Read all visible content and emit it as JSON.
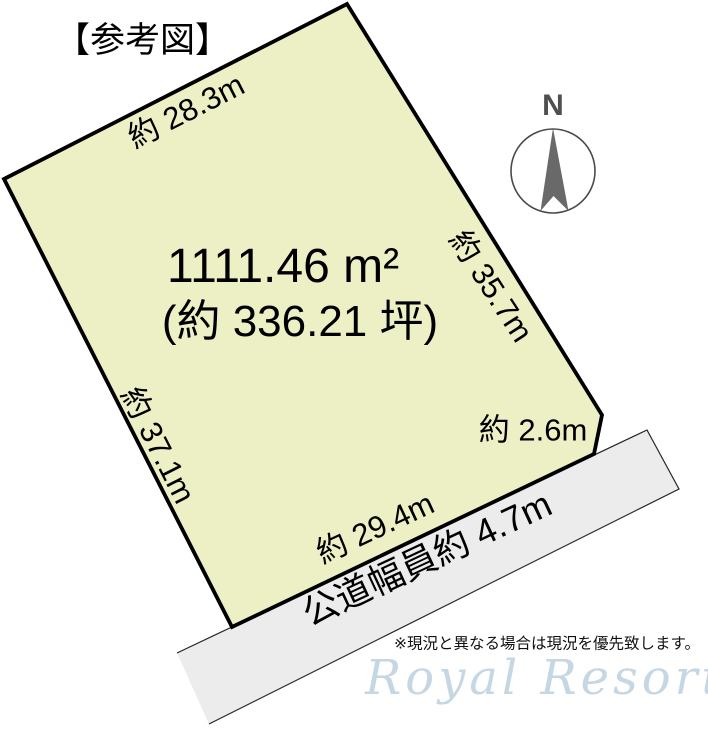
{
  "title": "【参考図】",
  "compass": {
    "north_label": "N"
  },
  "plot": {
    "area_m2": "1111.46 m²",
    "area_tsubo": "(約 336.21 坪)",
    "fill_color": "#edf0c5",
    "dimensions": {
      "top": "約 28.3m",
      "right": "約 35.7m",
      "left": "約 37.1m",
      "bottom": "約 29.4m",
      "corner": "約 2.6m"
    }
  },
  "road": {
    "label": "公道幅員約 4.7m",
    "fill_color": "#ececec"
  },
  "footer": {
    "note": "※現況と異なる場合は現況を優先致します。",
    "watermark": "Royal Resort",
    "watermark_color": "#b4cadc"
  }
}
